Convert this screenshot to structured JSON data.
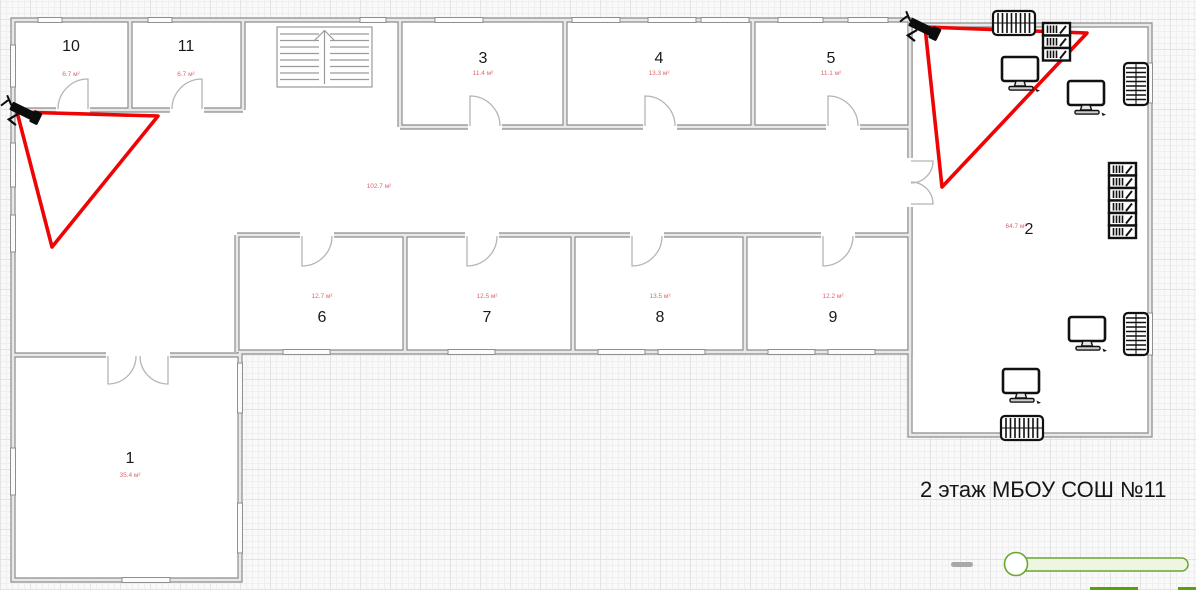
{
  "app": {
    "title": "2 этаж МБОУ СОШ №11"
  },
  "floor_plan": {
    "rooms": [
      {
        "number": "1",
        "area": "35.4 м²"
      },
      {
        "number": "2",
        "area": "64.7 м²"
      },
      {
        "number": "3",
        "area": "11.4 м²"
      },
      {
        "number": "4",
        "area": "13.3 м²"
      },
      {
        "number": "5",
        "area": "11.1 м²"
      },
      {
        "number": "6",
        "area": "12.7 м²"
      },
      {
        "number": "7",
        "area": "12.5 м²"
      },
      {
        "number": "8",
        "area": "13.5 м²"
      },
      {
        "number": "9",
        "area": "12.2 м²"
      },
      {
        "number": "10",
        "area": "6.7 м²"
      },
      {
        "number": "11",
        "area": "6.7 м²"
      }
    ],
    "corridor_area": "102.7 м²",
    "equipment": {
      "cameras": 2,
      "computers": 4,
      "radiators": 4,
      "bookshelves": 2,
      "staircases": 1
    }
  },
  "colors": {
    "camera_fov": "#ee0404",
    "area_label": "#dd6670",
    "slider_green": "#6aa62c",
    "button_green": "#57a20c",
    "wall_edge": "#8c8c8c"
  },
  "zoom_control": {
    "zoom_out_glyph": "−"
  }
}
